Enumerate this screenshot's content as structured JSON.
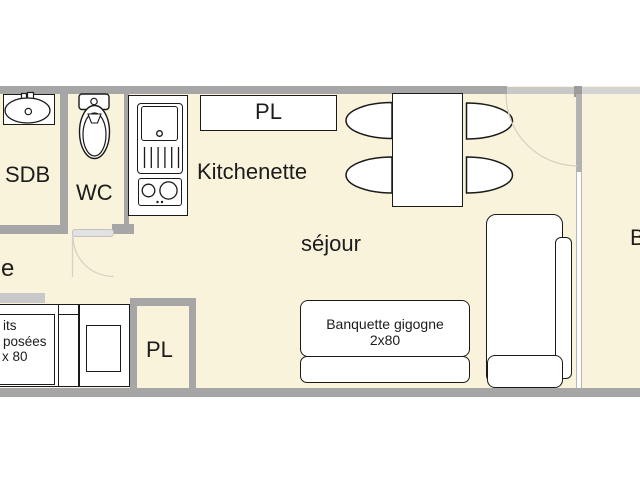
{
  "plan": {
    "type": "apartment floor plan",
    "labels": {
      "sdb": "SDB",
      "wc": "WC",
      "kitchenette": "Kitchenette",
      "closet_top": "PL",
      "closet_bottom": "PL",
      "sejour": "séjour",
      "entree_partial": "e",
      "balcony_partial": "B"
    },
    "furniture": {
      "banquette_line1": "Banquette gigogne",
      "banquette_line2": "2x80",
      "bunk_bed_line1": "its",
      "bunk_bed_line2": "posées",
      "bunk_bed_line3": "x 80"
    },
    "colors": {
      "floor": "#faf3dc",
      "wall": "#a6a6a6",
      "wall_light": "#c9c9c9",
      "line": "#1a1a1a",
      "door_arc": "#d6d1c1",
      "background": "#ffffff"
    }
  }
}
